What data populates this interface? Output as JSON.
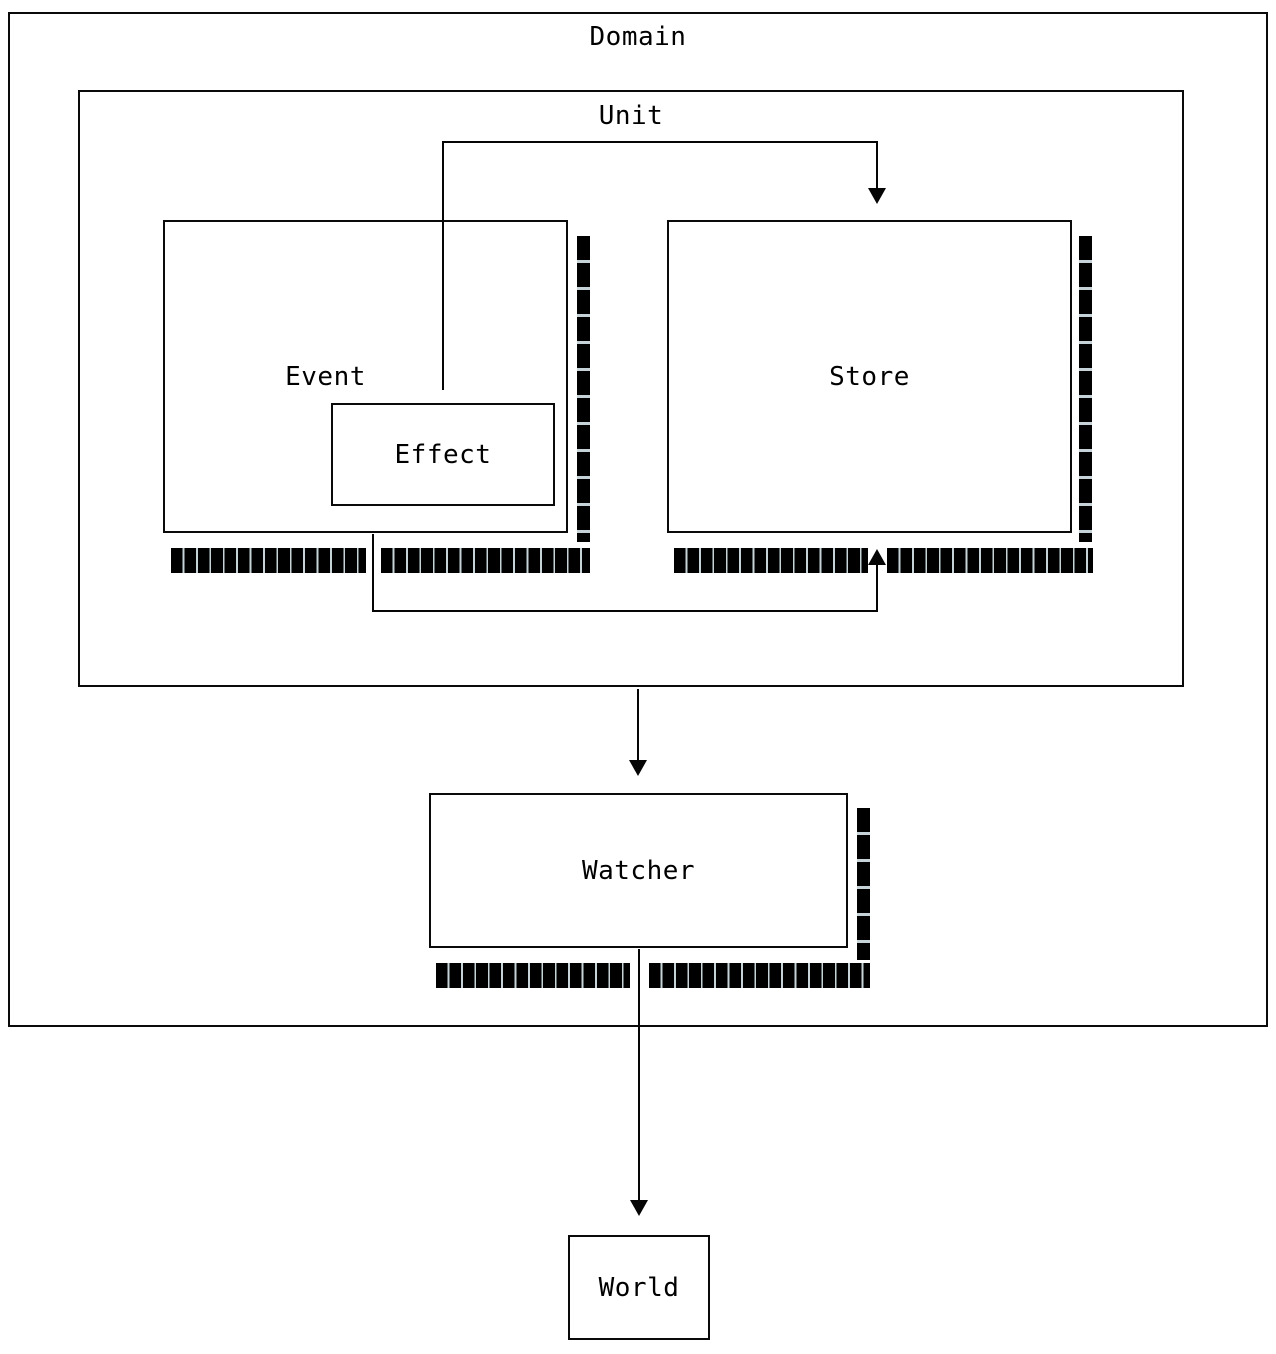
{
  "diagram": {
    "title": "Effector unit relations diagram",
    "background_color": "#ffffff",
    "line_color": "#000000",
    "boxes": {
      "domain": {
        "label": "Domain"
      },
      "unit": {
        "label": "Unit"
      },
      "event": {
        "label": "Event"
      },
      "effect": {
        "label": "Effect"
      },
      "store": {
        "label": "Store"
      },
      "watcher": {
        "label": "Watcher"
      },
      "world": {
        "label": "World"
      }
    },
    "arrows": [
      {
        "from": "event-effect",
        "to": "store",
        "route": "over-the-top",
        "head": "down"
      },
      {
        "from": "event",
        "to": "store",
        "route": "under-the-bottom",
        "head": "up"
      },
      {
        "from": "unit",
        "to": "watcher",
        "route": "straight-down",
        "head": "down"
      },
      {
        "from": "watcher",
        "to": "world",
        "route": "straight-down",
        "head": "down"
      }
    ]
  }
}
